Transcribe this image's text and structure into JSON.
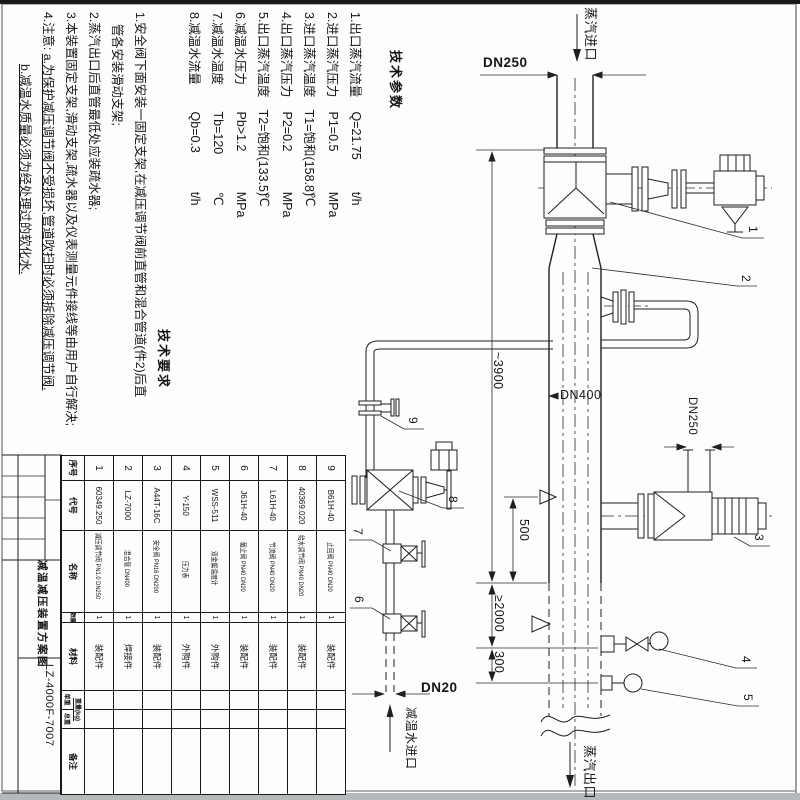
{
  "tech_params": {
    "title": "技术参数",
    "items": [
      {
        "label": "1.出口蒸汽流量",
        "value": "Q=21.75",
        "unit": "t/h"
      },
      {
        "label": "2.进口蒸汽压力",
        "value": "P1=0.5",
        "unit": "MPa"
      },
      {
        "label": "3.进口蒸汽温度",
        "value": "T1=饱和(158.8)",
        "unit": "℃"
      },
      {
        "label": "4.出口蒸汽压力",
        "value": "P2=0.2",
        "unit": "MPa"
      },
      {
        "label": "5.出口蒸汽温度",
        "value": "T2=饱和(133.5)",
        "unit": "℃"
      },
      {
        "label": "6.减温水压力",
        "value": "Pb>1.2",
        "unit": "MPa"
      },
      {
        "label": "7.减温水温度",
        "value": "Tb=120",
        "unit": "℃"
      },
      {
        "label": "8.减温水流量",
        "value": "Qb=0.3",
        "unit": "t/h"
      }
    ]
  },
  "tech_notes": {
    "title": "技术要求",
    "line1a": "1.安全阀下面安装一固定支架,在减压调节阀前直管和混合管道(件2)后直",
    "line1b": "管各安装滑动支架;",
    "line2": "2.蒸汽出口后直管最低处应装疏水器;",
    "line3": "3.本装置固定支架,滑动支架,疏水器以及仪表测量元件接线等由用户自行解决;",
    "note4_prefix": "4.注意: ",
    "note4_a": "a.为保护减压调节阀不受损坏,管道吹扫时必须拆除减压调节阀.",
    "note4_b": "b.减温水质量必须为经处理过的软化水."
  },
  "bom": {
    "headers": {
      "no": "序号",
      "code": "代号",
      "name": "名称",
      "qty": "数量",
      "material": "材料",
      "weight": "重量(kg)",
      "weight_each": "单重",
      "weight_total": "总重",
      "remark": "备注"
    },
    "rows": [
      {
        "no": "1",
        "code": "60349.250",
        "name": "减压调节阀 PN1.0 DN250",
        "qty": "1",
        "material": "装配件"
      },
      {
        "no": "2",
        "code": "LZ-7000",
        "name": "混合管 DN400",
        "qty": "1",
        "material": "焊接件"
      },
      {
        "no": "3",
        "code": "A44T-16C",
        "name": "安全阀 PN16 DN200",
        "qty": "1",
        "material": "装配件"
      },
      {
        "no": "4",
        "code": "Y-150",
        "name": "压力表",
        "qty": "1",
        "material": "外购件"
      },
      {
        "no": "5",
        "code": "WSS-511",
        "name": "双金属温度计",
        "qty": "1",
        "material": "外购件"
      },
      {
        "no": "6",
        "code": "J61H-40",
        "name": "截止阀 PN40 DN20",
        "qty": "1",
        "material": "装配件"
      },
      {
        "no": "7",
        "code": "L61H-40",
        "name": "节流阀 PN40 DN20",
        "qty": "1",
        "material": "装配件"
      },
      {
        "no": "8",
        "code": "40369.020",
        "name": "给水调节阀 PN40 DN20",
        "qty": "1",
        "material": "装配件"
      },
      {
        "no": "9",
        "code": "B61H-40",
        "name": "止回阀 PN40 DN20",
        "qty": "1",
        "material": "装配件"
      }
    ]
  },
  "title_block": {
    "title": "减温减压装置方案图",
    "drawing_no": "LZ-4000F-7007"
  },
  "flow_labels": {
    "steam_inlet": "蒸汽进口",
    "steam_outlet": "蒸汽出口",
    "water_inlet": "减温水进口"
  },
  "dims": {
    "dn250_top": "DN250",
    "dn400": "DN400",
    "dn250_vent": "DN250",
    "dn20": "DN20",
    "h3900": "~3900",
    "d500": "500",
    "d2000": "≥2000",
    "d300": "300"
  },
  "callouts": [
    "1",
    "2",
    "3",
    "4",
    "5",
    "6",
    "7",
    "8",
    "9"
  ]
}
